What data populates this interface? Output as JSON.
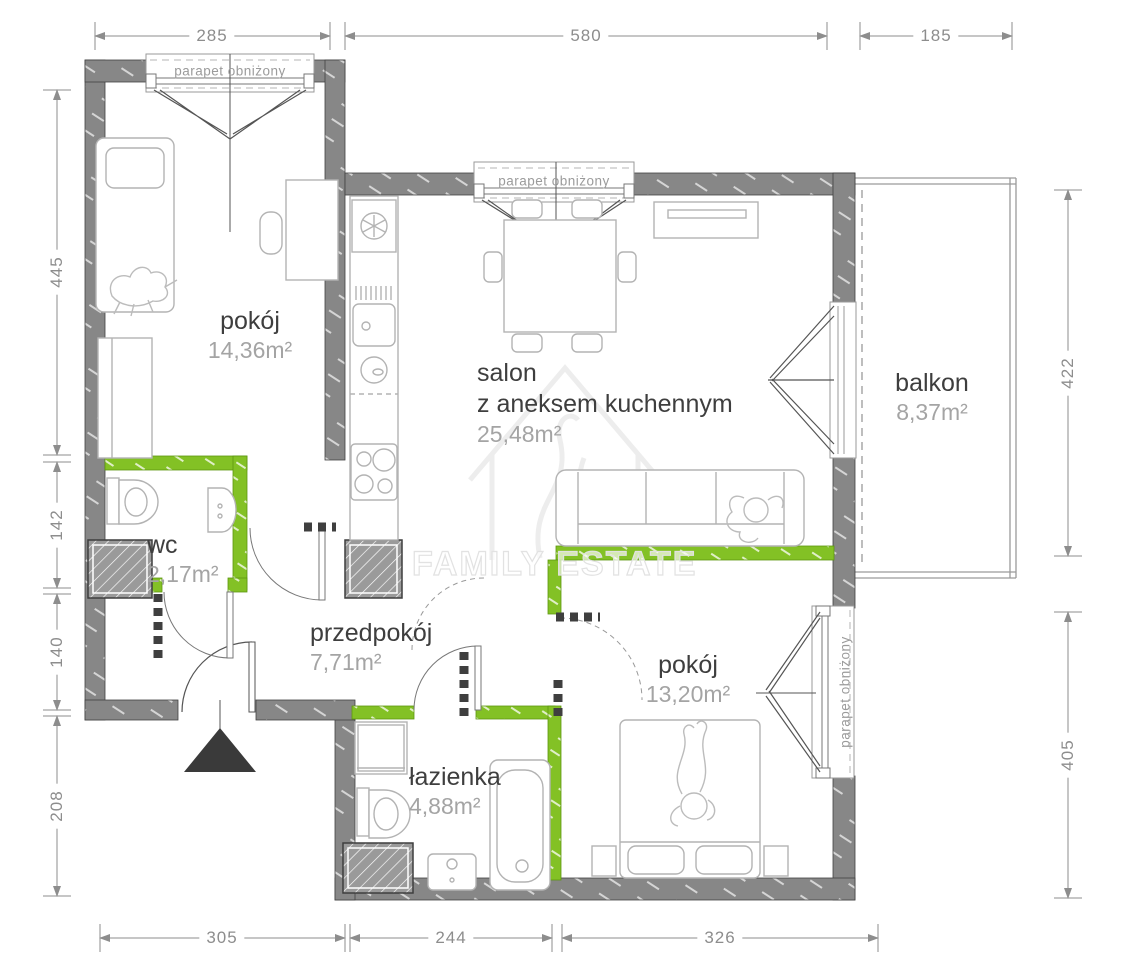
{
  "plan": {
    "watermark_text": "FAMILY ESTATE",
    "window_label": "parapet obniżony",
    "rooms": [
      {
        "name": "pokój",
        "area": "14,36m²"
      },
      {
        "name": "salon",
        "name2": "z aneksem kuchennym",
        "area": "25,48m²"
      },
      {
        "name": "balkon",
        "area": "8,37m²"
      },
      {
        "name": "wc",
        "area": "2,17m²"
      },
      {
        "name": "przedpokój",
        "area": "7,71m²"
      },
      {
        "name": "łazienka",
        "area": "4,88m²"
      },
      {
        "name": "pokój",
        "area": "13,20m²"
      }
    ],
    "dimensions_cm": {
      "top": [
        "285",
        "580",
        "185"
      ],
      "left": [
        "445",
        "142",
        "140",
        "208"
      ],
      "right": [
        "422",
        "405"
      ],
      "bottom": [
        "305",
        "244",
        "326"
      ]
    },
    "colors": {
      "wall_gray": "#878787",
      "accent_green": "#85c226"
    }
  }
}
